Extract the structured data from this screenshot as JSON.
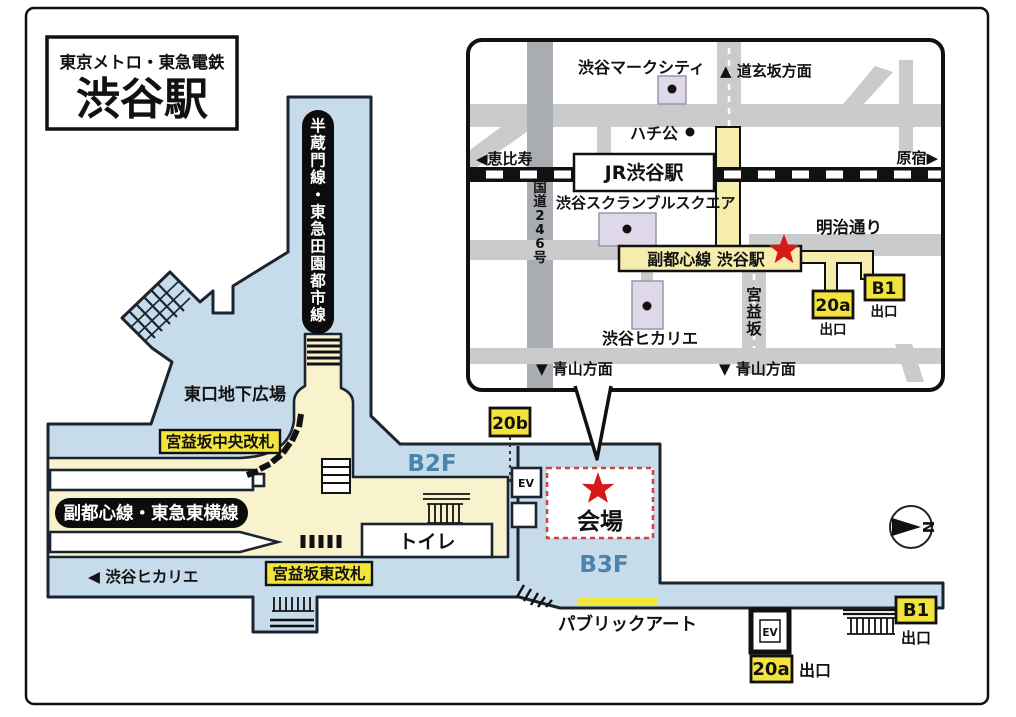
{
  "title": {
    "line1": "東京メトロ・東急電鉄",
    "line2": "渋谷駅"
  },
  "inset": {
    "mark_city": "渋谷マークシティ",
    "dogenzaka": "▲ 道玄坂方面",
    "hachiko": "ハチ公",
    "ebisu": "◀恵比寿",
    "harajuku": "原宿▶",
    "jr_station": "JR渋谷駅",
    "route246": "国道246号",
    "scramble_square": "渋谷スクランブルスクエア",
    "meiji_dori": "明治通り",
    "fukutoshin_station": "副都心線 渋谷駅",
    "hikarie": "渋谷ヒカリエ",
    "miyamasuzaka": "宮益坂",
    "aoyama_left": "▼ 青山方面",
    "aoyama_right": "▼ 青山方面",
    "badge_20a": "20a",
    "badge_20a_exit": "出口",
    "badge_b1": "B1",
    "badge_b1_exit": "出口"
  },
  "station": {
    "hanzomon_line": "半蔵門線・東急田園都市線",
    "east_plaza": "東口地下広場",
    "central_gate": "宮益坂中央改札",
    "east_gate": "宮益坂東改札",
    "fukutoshin_toyoko_line": "副都心線・東急東横線",
    "hikarie_dir": "◀ 渋谷ヒカリエ",
    "toilet": "トイレ",
    "b2f": "B2F",
    "b3f": "B3F",
    "badge_20b": "20b",
    "venue": "会場",
    "public_art": "パブリックアート",
    "ev_upper": "EV",
    "ev_lower": "EV",
    "badge_20a": "20a",
    "badge_20a_exit": "出口",
    "badge_b1": "B1",
    "badge_b1_exit": "出口",
    "compass_n": "N"
  },
  "colors": {
    "station_blue": "#c7dcea",
    "paid_yellow": "#f8f3cd",
    "badge_yellow": "#f3e33d",
    "outline_dark": "#1b2430",
    "road_gray": "#c9cbcd",
    "road_dark_gray": "#a9adb1",
    "building_lavender": "#ded8e8",
    "floor_label_blue": "#4b83ab",
    "star_red": "#d81717",
    "venue_border_red": "#cc4444"
  }
}
